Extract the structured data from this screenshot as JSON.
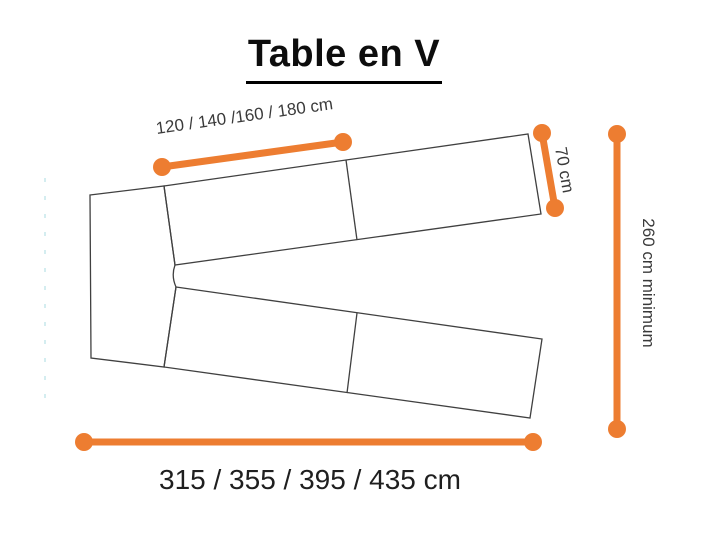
{
  "title": "Table en V",
  "colors": {
    "dimension": "#ED7D31",
    "outline": "#404040",
    "guide": "#b9e2e6"
  },
  "diagram": {
    "labels": {
      "segment_length": "120 / 140 /160 / 180 cm",
      "depth": "70 cm",
      "height_min": "260 cm minimum",
      "total_width": "315 / 355 / 395 / 435 cm"
    }
  }
}
